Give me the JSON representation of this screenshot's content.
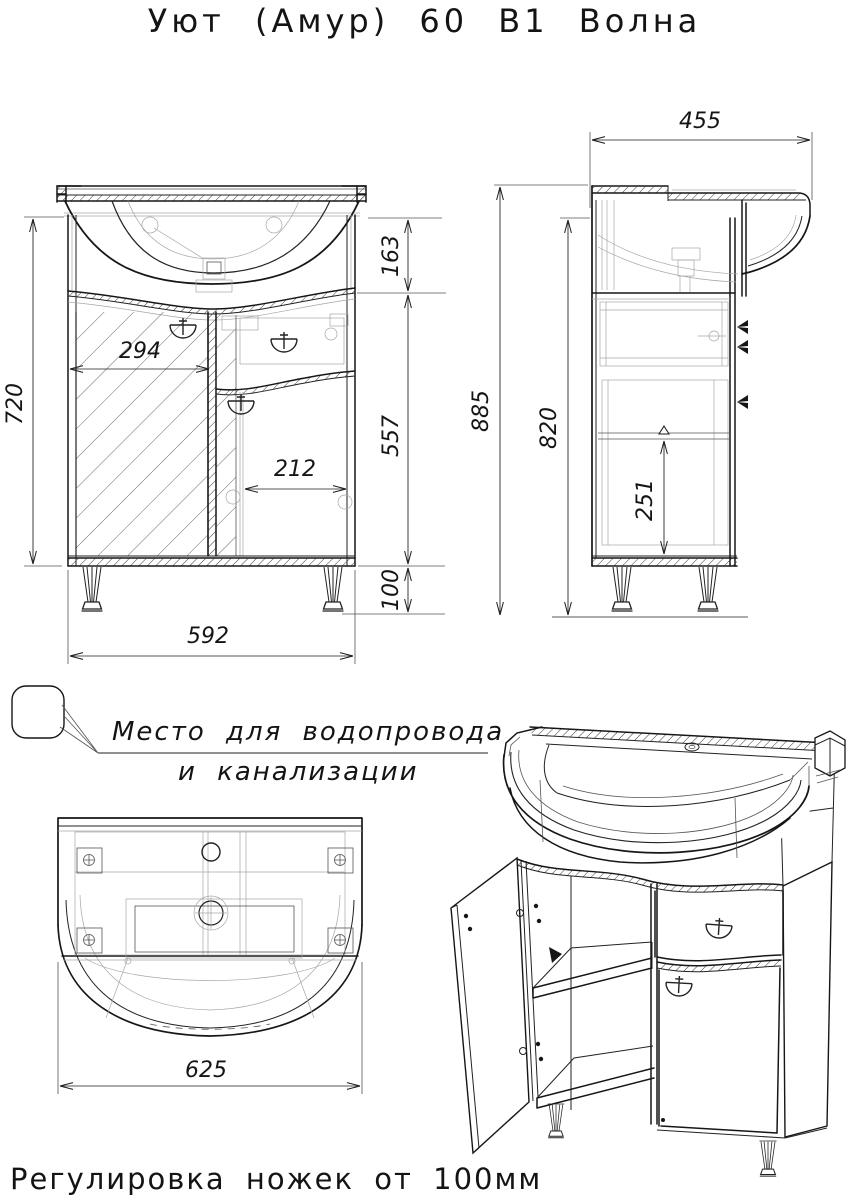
{
  "title": "Уют (Амур) 60 В1 Волна",
  "note": {
    "line1": "Место для водопровода",
    "line2": "и канализации"
  },
  "footer": "Регулировка ножек от 100мм",
  "dimensions": {
    "front": {
      "overall_height": "720",
      "sink_zone_height": "163",
      "cabinet_height": "557",
      "leg_height": "100",
      "left_door_width": "294",
      "right_door_width": "212",
      "cabinet_width": "592"
    },
    "side": {
      "depth": "455",
      "total_height": "885",
      "body_height": "820",
      "shelf_clearance": "251"
    },
    "top": {
      "sink_width": "625"
    }
  },
  "colors": {
    "line": "#161616",
    "construction": "#a6a6a6",
    "background": "#ffffff"
  }
}
